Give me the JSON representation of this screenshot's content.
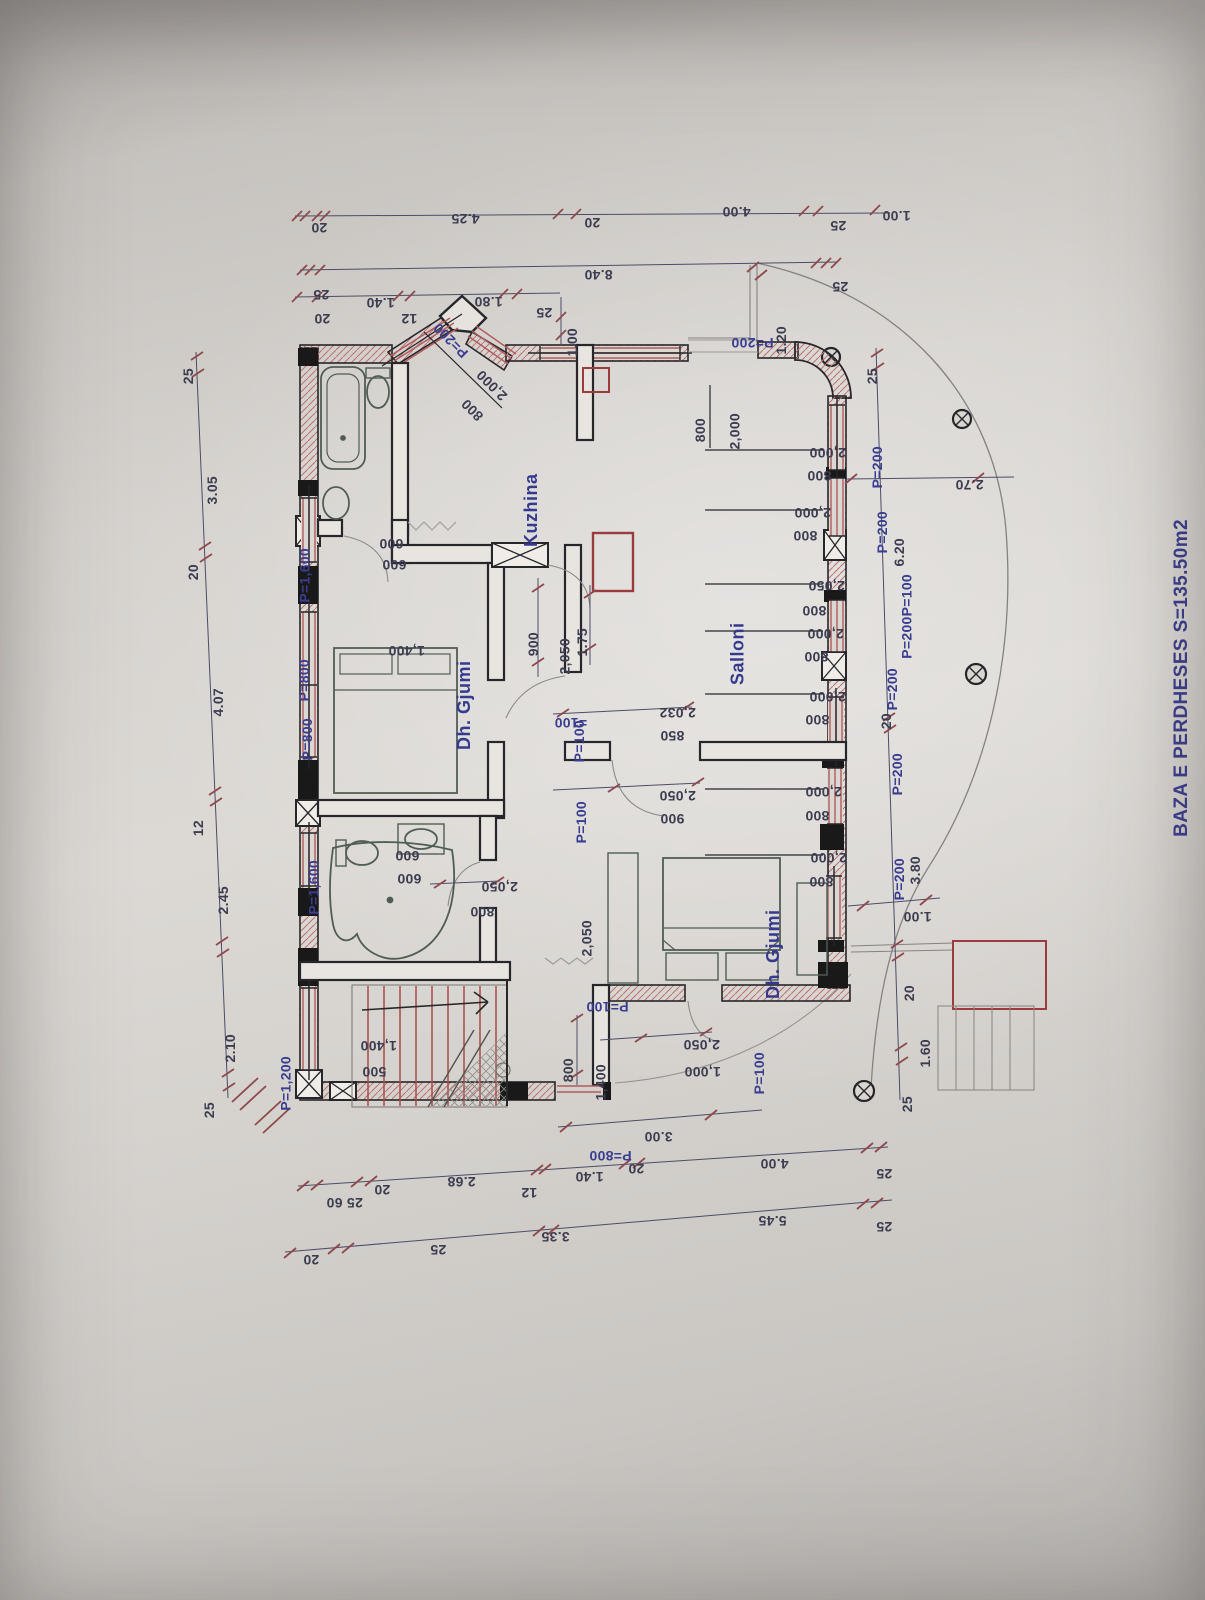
{
  "meta": {
    "title": "BAZA E PERDHESES S=135.50m2"
  },
  "colors": {
    "annotation_blue": "#3a3e97",
    "dimension_dark": "#3d3d52",
    "wall_black": "#26262b",
    "masonry_red": "#b75a5a",
    "tick_red": "#93484e",
    "paper": "#d6d3cf"
  },
  "rooms": [
    {
      "label": "Kuzhina",
      "x": 505,
      "y": 463
    },
    {
      "label": "Dh. Gjumi",
      "x": 430,
      "y": 650
    },
    {
      "label": "Salloni",
      "x": 717,
      "y": 612
    },
    {
      "label": "Dh. Gjumi",
      "x": 739,
      "y": 899
    }
  ],
  "labels": [
    {
      "t": "20",
      "x": 303,
      "y": 212,
      "r": 180
    },
    {
      "t": "4.25",
      "x": 437,
      "y": 203,
      "r": 180
    },
    {
      "t": "20",
      "x": 576,
      "y": 207,
      "r": 180
    },
    {
      "t": "4.00",
      "x": 708,
      "y": 196,
      "r": 180
    },
    {
      "t": "25",
      "x": 822,
      "y": 210,
      "r": 180
    },
    {
      "t": "1.00",
      "x": 868,
      "y": 200,
      "r": 180
    },
    {
      "t": "8.40",
      "x": 570,
      "y": 259,
      "r": 180
    },
    {
      "t": "25",
      "x": 305,
      "y": 279,
      "r": 180
    },
    {
      "t": "25",
      "x": 824,
      "y": 271,
      "r": 180
    },
    {
      "t": "20",
      "x": 306,
      "y": 303,
      "r": 180
    },
    {
      "t": "1.40",
      "x": 352,
      "y": 287,
      "r": 180
    },
    {
      "t": "12",
      "x": 393,
      "y": 303,
      "r": 180
    },
    {
      "t": "1.80",
      "x": 460,
      "y": 286,
      "r": 180
    },
    {
      "t": "25",
      "x": 528,
      "y": 297,
      "r": 180
    },
    {
      "t": "1.00",
      "x": 566,
      "y": 320,
      "r": 270
    },
    {
      "t": "P=200",
      "x": 420,
      "y": 312,
      "r": 225,
      "c": "b"
    },
    {
      "t": "P=200",
      "x": 710,
      "y": 327,
      "r": 180,
      "c": "b"
    },
    {
      "t": "1.20",
      "x": 775,
      "y": 318,
      "r": 270
    },
    {
      "t": "2,000",
      "x": 466,
      "y": 359,
      "r": 225
    },
    {
      "t": "800",
      "x": 457,
      "y": 388,
      "r": 225
    },
    {
      "t": "25",
      "x": 188,
      "y": 360,
      "r": 270
    },
    {
      "t": "3.05",
      "x": 206,
      "y": 468,
      "r": 270
    },
    {
      "t": "20",
      "x": 193,
      "y": 556,
      "r": 270
    },
    {
      "t": "4.07",
      "x": 212,
      "y": 680,
      "r": 270
    },
    {
      "t": "12",
      "x": 198,
      "y": 812,
      "r": 270
    },
    {
      "t": "2.45",
      "x": 217,
      "y": 878,
      "r": 270
    },
    {
      "t": "2.10",
      "x": 224,
      "y": 1026,
      "r": 270
    },
    {
      "t": "25",
      "x": 209,
      "y": 1094,
      "r": 270
    },
    {
      "t": "25",
      "x": 872,
      "y": 360,
      "r": 270
    },
    {
      "t": "2.70",
      "x": 941,
      "y": 469,
      "r": 180
    },
    {
      "t": "6.20",
      "x": 893,
      "y": 530,
      "r": 270
    },
    {
      "t": "20",
      "x": 886,
      "y": 705,
      "r": 270
    },
    {
      "t": "3.80",
      "x": 909,
      "y": 848,
      "r": 270
    },
    {
      "t": "1.00",
      "x": 889,
      "y": 901,
      "r": 180
    },
    {
      "t": "20",
      "x": 909,
      "y": 977,
      "r": 270
    },
    {
      "t": "1.60",
      "x": 919,
      "y": 1031,
      "r": 270
    },
    {
      "t": "25",
      "x": 907,
      "y": 1088,
      "r": 270
    },
    {
      "t": "P=200",
      "x": 864,
      "y": 438,
      "r": 270,
      "c": "b"
    },
    {
      "t": "P=200",
      "x": 869,
      "y": 503,
      "r": 270,
      "c": "b"
    },
    {
      "t": "P=200P=100",
      "x": 872,
      "y": 566,
      "r": 270,
      "c": "b"
    },
    {
      "t": "P=200",
      "x": 879,
      "y": 660,
      "r": 270,
      "c": "b"
    },
    {
      "t": "P=200",
      "x": 884,
      "y": 745,
      "r": 270,
      "c": "b"
    },
    {
      "t": "P=200",
      "x": 886,
      "y": 850,
      "r": 270,
      "c": "b"
    },
    {
      "t": "800",
      "x": 696,
      "y": 410,
      "r": 270
    },
    {
      "t": "2,000",
      "x": 724,
      "y": 405,
      "r": 270
    },
    {
      "t": "2,000",
      "x": 791,
      "y": 437,
      "r": 180
    },
    {
      "t": "800",
      "x": 795,
      "y": 460,
      "r": 180
    },
    {
      "t": "2,000",
      "x": 776,
      "y": 497,
      "r": 180
    },
    {
      "t": "800",
      "x": 781,
      "y": 520,
      "r": 180
    },
    {
      "t": "2,050",
      "x": 790,
      "y": 570,
      "r": 180
    },
    {
      "t": "800",
      "x": 790,
      "y": 595,
      "r": 180
    },
    {
      "t": "2,000",
      "x": 789,
      "y": 618,
      "r": 180
    },
    {
      "t": "800",
      "x": 792,
      "y": 641,
      "r": 180
    },
    {
      "t": "2,000",
      "x": 791,
      "y": 681,
      "r": 180
    },
    {
      "t": "800",
      "x": 793,
      "y": 704,
      "r": 180
    },
    {
      "t": "2,000",
      "x": 787,
      "y": 776,
      "r": 180
    },
    {
      "t": "800",
      "x": 793,
      "y": 800,
      "r": 180
    },
    {
      "t": "2,000",
      "x": 792,
      "y": 842,
      "r": 180
    },
    {
      "t": "800",
      "x": 797,
      "y": 866,
      "r": 180
    },
    {
      "t": "P=1,600",
      "x": 285,
      "y": 540,
      "r": 270,
      "c": "b"
    },
    {
      "t": "600",
      "x": 367,
      "y": 528,
      "r": 180
    },
    {
      "t": "600",
      "x": 370,
      "y": 549,
      "r": 180
    },
    {
      "t": "P=800",
      "x": 291,
      "y": 651,
      "r": 270,
      "c": "b"
    },
    {
      "t": "P=800",
      "x": 294,
      "y": 710,
      "r": 270,
      "c": "b"
    },
    {
      "t": "1,400",
      "x": 370,
      "y": 635,
      "r": 180
    },
    {
      "t": "P=1,600",
      "x": 294,
      "y": 852,
      "r": 270,
      "c": "b"
    },
    {
      "t": "600",
      "x": 383,
      "y": 840,
      "r": 180
    },
    {
      "t": "600",
      "x": 385,
      "y": 863,
      "r": 180
    },
    {
      "t": "P=1,200",
      "x": 266,
      "y": 1048,
      "r": 270,
      "c": "b"
    },
    {
      "t": "1,400",
      "x": 342,
      "y": 1030,
      "r": 180
    },
    {
      "t": "500",
      "x": 350,
      "y": 1056,
      "r": 180
    },
    {
      "t": "900",
      "x": 529,
      "y": 624,
      "r": 270
    },
    {
      "t": "2,050",
      "x": 554,
      "y": 630,
      "r": 270
    },
    {
      "t": "1.75",
      "x": 576,
      "y": 620,
      "r": 270
    },
    {
      "t": "=100",
      "x": 538,
      "y": 707,
      "r": 180,
      "c": "b"
    },
    {
      "t": "P=100",
      "x": 566,
      "y": 712,
      "r": 270,
      "c": "b"
    },
    {
      "t": "2,032",
      "x": 641,
      "y": 697,
      "r": 180
    },
    {
      "t": "850",
      "x": 648,
      "y": 720,
      "r": 180
    },
    {
      "t": "P=100",
      "x": 568,
      "y": 793,
      "r": 270,
      "c": "b"
    },
    {
      "t": "2,050",
      "x": 641,
      "y": 780,
      "r": 180
    },
    {
      "t": "900",
      "x": 648,
      "y": 803,
      "r": 180
    },
    {
      "t": "2,050",
      "x": 463,
      "y": 871,
      "r": 180
    },
    {
      "t": "800",
      "x": 458,
      "y": 896,
      "r": 180
    },
    {
      "t": "2,050",
      "x": 576,
      "y": 912,
      "r": 270
    },
    {
      "t": "P=100",
      "x": 565,
      "y": 991,
      "r": 180,
      "c": "b"
    },
    {
      "t": "800",
      "x": 564,
      "y": 1050,
      "r": 270
    },
    {
      "t": "1,400",
      "x": 590,
      "y": 1056,
      "r": 270
    },
    {
      "t": "2,050",
      "x": 665,
      "y": 1029,
      "r": 180
    },
    {
      "t": "1,000",
      "x": 666,
      "y": 1056,
      "r": 180
    },
    {
      "t": "P=100",
      "x": 746,
      "y": 1044,
      "r": 270,
      "c": "b"
    },
    {
      "t": "3.00",
      "x": 630,
      "y": 1121,
      "r": 180
    },
    {
      "t": "P=800",
      "x": 568,
      "y": 1140,
      "r": 180,
      "c": "b"
    },
    {
      "t": "25 60",
      "x": 308,
      "y": 1187,
      "r": 180
    },
    {
      "t": "20",
      "x": 366,
      "y": 1174,
      "r": 180
    },
    {
      "t": "2.68",
      "x": 433,
      "y": 1166,
      "r": 180
    },
    {
      "t": "12",
      "x": 513,
      "y": 1177,
      "r": 180
    },
    {
      "t": "1.40",
      "x": 561,
      "y": 1161,
      "r": 180
    },
    {
      "t": "20",
      "x": 620,
      "y": 1153,
      "r": 180
    },
    {
      "t": "4.00",
      "x": 746,
      "y": 1148,
      "r": 180
    },
    {
      "t": "25",
      "x": 868,
      "y": 1158,
      "r": 180
    },
    {
      "t": "20",
      "x": 295,
      "y": 1244,
      "r": 180
    },
    {
      "t": "25",
      "x": 422,
      "y": 1234,
      "r": 180
    },
    {
      "t": "3.35",
      "x": 527,
      "y": 1221,
      "r": 180
    },
    {
      "t": "5.45",
      "x": 744,
      "y": 1205,
      "r": 180
    },
    {
      "t": "25",
      "x": 868,
      "y": 1211,
      "r": 180
    }
  ]
}
